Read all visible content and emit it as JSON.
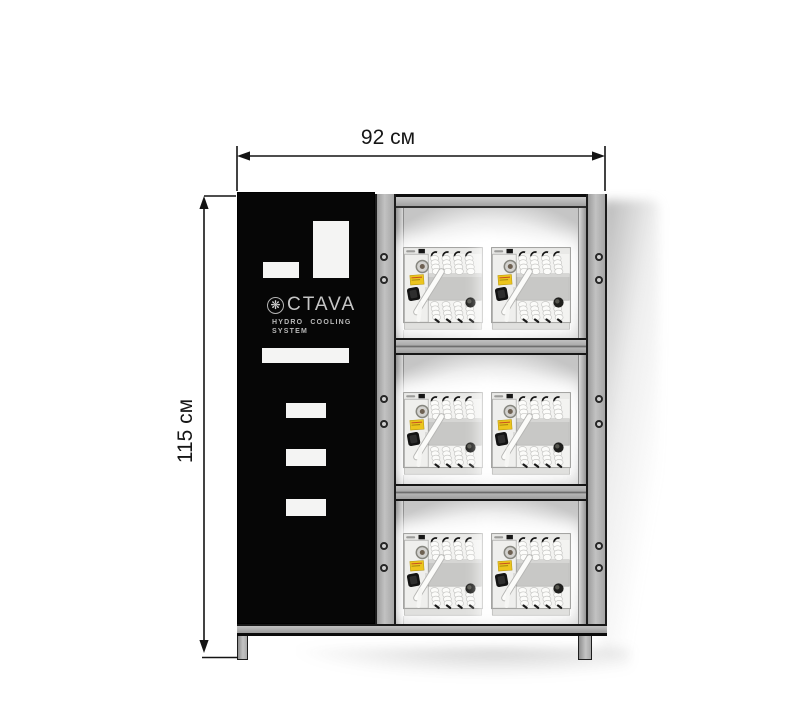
{
  "annotations": {
    "width_label": "92 см",
    "height_label": "115 см"
  },
  "cabinet": {
    "brand": "CTAVA",
    "brand_icon": "snowflake-icon",
    "brand_icon_glyph": "❋",
    "tagline_line1": "HYDRO COOLING",
    "tagline_line2": "SYSTEM",
    "shelf_count": 3,
    "units_per_shelf": 2
  },
  "colors": {
    "frame_gray": "#b0b0b0",
    "panel_black": "#060606",
    "dimension_line": "#141414",
    "unit_label_yellow": "#ecc51d"
  }
}
